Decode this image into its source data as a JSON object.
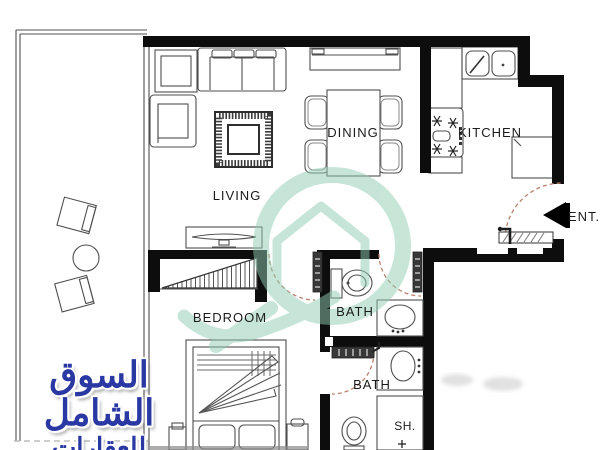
{
  "plan": {
    "rooms": {
      "living": "LIVING",
      "dining": "DINING",
      "kitchen": "KITCHEN",
      "bedroom": "BEDROOM",
      "bath_top": "BATH",
      "bath_bottom": "BATH",
      "shower": "SH.",
      "entrance": "ENT."
    }
  },
  "watermark": {
    "brand_line1": "السوق الشامل",
    "brand_line2": "للعقارات",
    "brand_color": "#2a38a4",
    "logo_color": "#8fcdb2"
  }
}
